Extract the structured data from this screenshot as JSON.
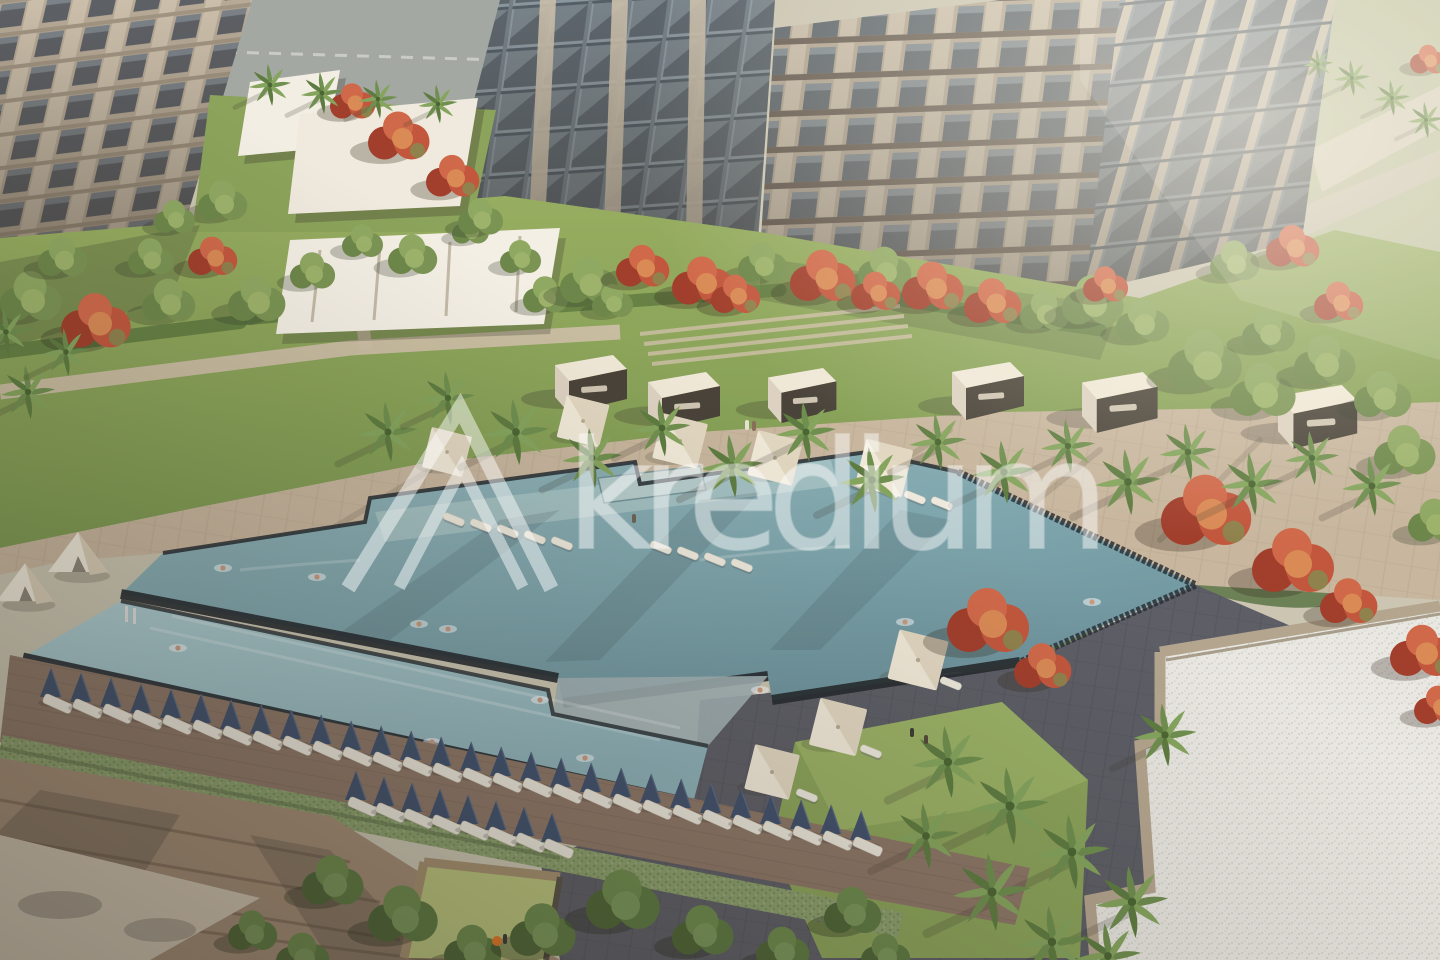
{
  "scene": {
    "description": "Aerial 3D rendering of a residential complex courtyard with geometric swimming pools, sun deck, cabanas, palm trees and flowering red trees",
    "elements": [
      "apartment buildings",
      "upper infinity pool",
      "lower lap pool",
      "lounger rows",
      "cabanas",
      "parasols",
      "palm trees",
      "red flame trees",
      "gravel roof",
      "garden terraces"
    ]
  },
  "watermark": {
    "text": "kredium"
  },
  "colors": {
    "backdrop_warm": "#cbc5b2",
    "backdrop_green": "#bcbf9e",
    "road": "#a4a8a3",
    "facade_beige": "#b7aa97",
    "facade_pier": "#cbbfab",
    "facade_dark": "#8b7f6e",
    "glass": "#8b979e",
    "glass_dark": "#5d666d",
    "garden_green": "#8ba35a",
    "lawn_light": "#a9bf70",
    "hedge_green": "#5f7a40",
    "tree_green": "#7b9454",
    "tree_red": "#c2573d",
    "palm_green": "#6f8f4f",
    "deck_tan": "#c8b69e",
    "deck_line": "#b09e86",
    "pool_upper": "#7fa6ad",
    "pool_lower": "#9fc2c7",
    "pool_edge": "#262b30",
    "deck_dark": "#5d5e66",
    "wood_walk": "#8d7767",
    "gravel": "#e9e7e1",
    "parapet": "#b4a58e",
    "wall_tan": "#a28c75",
    "plaza": "#cfc3b0",
    "terrace_green": "#b9c37c",
    "cabana_roof": "#f0e8d7",
    "umbrella": "#f1e9d8",
    "lounger_navy": "#41516c",
    "lounger_white": "#ece7db",
    "watermark": "#ffffff"
  }
}
